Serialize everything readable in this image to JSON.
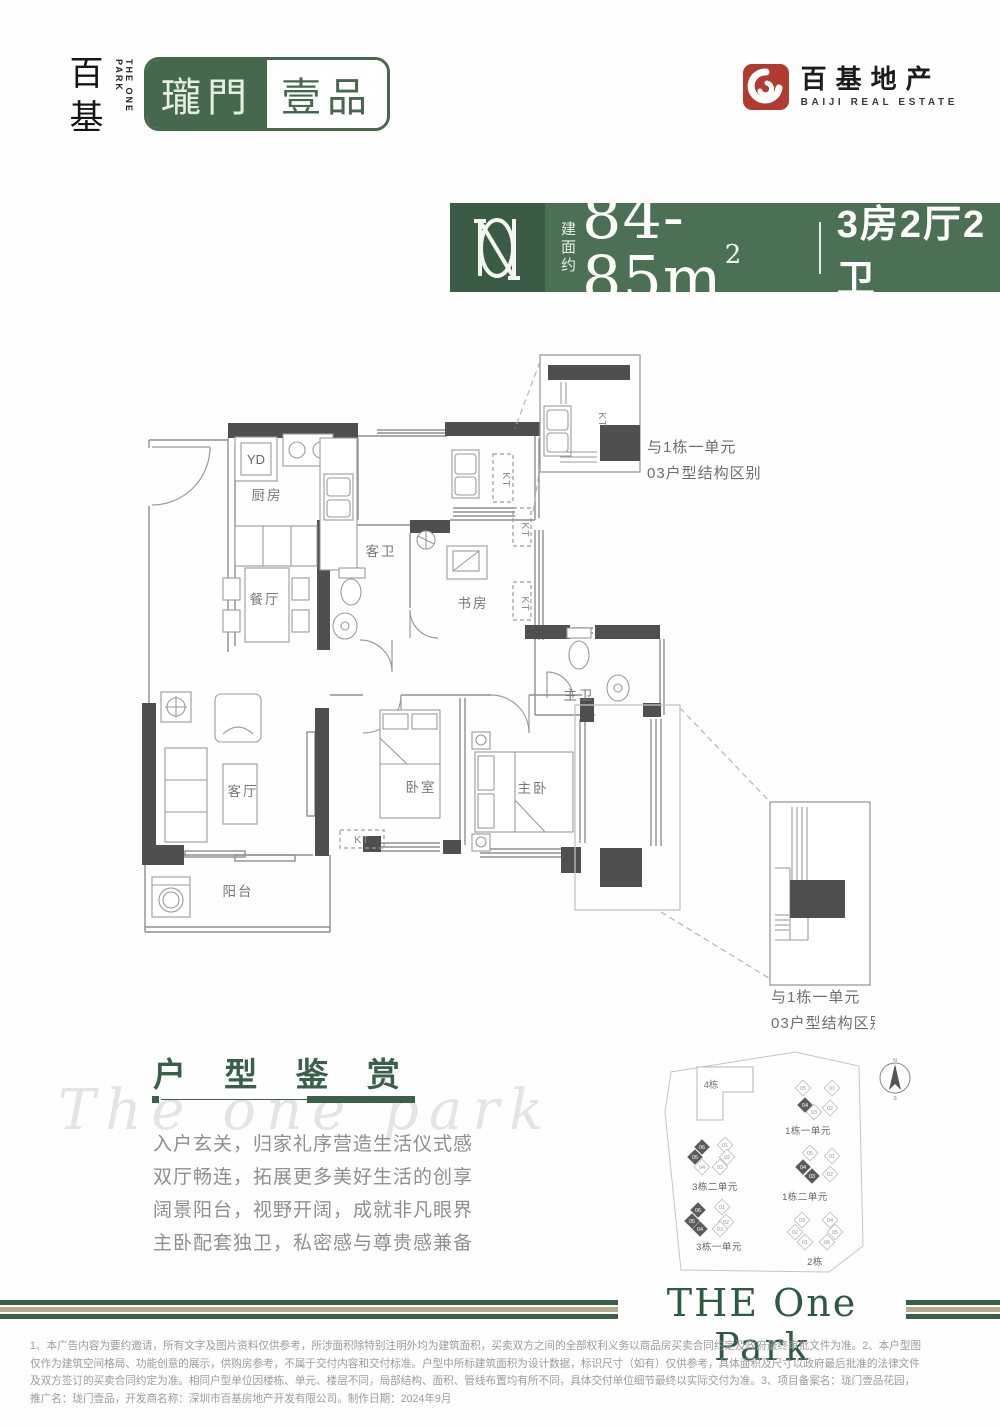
{
  "brand": {
    "left": {
      "chars": "百基",
      "sub": "THE ONE PARK",
      "seal_a": "瓏門",
      "seal_b": "壹品"
    },
    "right": {
      "name": "百基地产",
      "sub": "BAIJI REAL ESTATE"
    }
  },
  "headline": {
    "area_label": "建面约",
    "area": "84-85m",
    "sup": "2",
    "rooms": "3房2厅2卫"
  },
  "floorplan": {
    "yd": "YD",
    "kt": "KT",
    "rooms": [
      {
        "name": "厨房",
        "x": 172,
        "y": 160
      },
      {
        "name": "餐厅",
        "x": 170,
        "y": 264
      },
      {
        "name": "客卫",
        "x": 286,
        "y": 216
      },
      {
        "name": "书房",
        "x": 378,
        "y": 268
      },
      {
        "name": "主卫",
        "x": 484,
        "y": 360
      },
      {
        "name": "客厅",
        "x": 148,
        "y": 456
      },
      {
        "name": "阳台",
        "x": 143,
        "y": 556
      },
      {
        "name": "卧室",
        "x": 326,
        "y": 452
      },
      {
        "name": "主卧",
        "x": 438,
        "y": 453
      }
    ],
    "kt_marks": [
      {
        "x": 427,
        "y": 190,
        "rot": 90
      },
      {
        "x": 427,
        "y": 264,
        "rot": 90
      },
      {
        "x": 267,
        "y": 503,
        "rot": 0
      },
      {
        "x": 408,
        "y": 140,
        "rot": 90
      },
      {
        "x": 504,
        "y": 80,
        "rot": 90
      }
    ],
    "callouts": [
      {
        "lines": [
          "与1栋一单元",
          "03户型结构区别"
        ],
        "x": 552,
        "y": 112,
        "dy": 26
      },
      {
        "lines": [
          "与1栋一单元",
          "03户型结构区别"
        ],
        "x": 676,
        "y": 662,
        "dy": 26
      }
    ]
  },
  "appreciation": {
    "watermark": "The one park",
    "title": "户 型 鉴 赏",
    "lines": [
      "入户玄关，归家礼序营造生活仪式感",
      "双厅畅连，拓展更多美好生活的创享",
      "阔景阳台，视野开阔，成就非凡眼界",
      "主卧配套独卫，私密感与尊贵感兼备"
    ]
  },
  "siteplan": {
    "buildings": [
      {
        "label": "4栋",
        "x": 66,
        "y": 48
      }
    ],
    "clusters": [
      {
        "label": "1栋一单元",
        "lx": 163,
        "ly": 94,
        "units": [
          {
            "n": "05",
            "x": 158,
            "y": 48
          },
          {
            "n": "01",
            "x": 187,
            "y": 48
          },
          {
            "n": "04",
            "x": 160,
            "y": 65,
            "dark": true
          },
          {
            "n": "03",
            "x": 169,
            "y": 72
          },
          {
            "n": "02",
            "x": 185,
            "y": 68
          }
        ]
      },
      {
        "label": "3栋二单元",
        "lx": 70,
        "ly": 150,
        "units": [
          {
            "n": "06",
            "x": 57,
            "y": 107,
            "dark": true
          },
          {
            "n": "01",
            "x": 80,
            "y": 105
          },
          {
            "n": "05",
            "x": 50,
            "y": 117,
            "dark": true
          },
          {
            "n": "02",
            "x": 82,
            "y": 117
          },
          {
            "n": "04",
            "x": 57,
            "y": 127
          },
          {
            "n": "03",
            "x": 75,
            "y": 127
          }
        ]
      },
      {
        "label": "1栋二单元",
        "lx": 160,
        "ly": 160,
        "units": [
          {
            "n": "05",
            "x": 165,
            "y": 113
          },
          {
            "n": "01",
            "x": 187,
            "y": 116
          },
          {
            "n": "04",
            "x": 158,
            "y": 127,
            "dark": true
          },
          {
            "n": "03",
            "x": 167,
            "y": 136,
            "dark": true
          },
          {
            "n": "02",
            "x": 185,
            "y": 134
          }
        ]
      },
      {
        "label": "3栋一单元",
        "lx": 74,
        "ly": 210,
        "units": [
          {
            "n": "06",
            "x": 53,
            "y": 170,
            "dark": true
          },
          {
            "n": "01",
            "x": 77,
            "y": 167
          },
          {
            "n": "05",
            "x": 47,
            "y": 181,
            "dark": true
          },
          {
            "n": "02",
            "x": 81,
            "y": 182
          },
          {
            "n": "04",
            "x": 55,
            "y": 189,
            "dark": true
          },
          {
            "n": "03",
            "x": 75,
            "y": 189
          }
        ]
      },
      {
        "label": "2栋",
        "lx": 170,
        "ly": 225,
        "units": [
          {
            "n": "03",
            "x": 157,
            "y": 180
          },
          {
            "n": "04",
            "x": 185,
            "y": 180
          },
          {
            "n": "02",
            "x": 150,
            "y": 192
          },
          {
            "n": "05",
            "x": 190,
            "y": 192
          },
          {
            "n": "01",
            "x": 160,
            "y": 202
          },
          {
            "n": "06",
            "x": 182,
            "y": 202
          }
        ]
      }
    ],
    "compass": {
      "n": "N",
      "s": "S"
    }
  },
  "footer": {
    "banner": "THE One Park"
  },
  "disclaimer": [
    "1、本广告内容为要约邀请，所有文字及图片资料仅供参考，所涉面积除特别注明外均为建筑面积，买卖双方之间的全部权利义务以商品房买卖合同约定及政府最终审批文件为准。2、本户型图",
    "仅作为建筑空间格局、功能创意的展示，供购房参考，不属于交付内容和交付标准。户型中所标建筑面积为设计数据，标识尺寸（如有）仅供参考，具体面积及尺寸以政府最后批准的法律文件",
    "及双方签订的买卖合同约定为准。相同户型单位因楼栋、单元、楼层不同，局部结构、面积、管线布置均有所不同，具体交付单位细节最终以实际交付为准。3、项目备案名：珑门壹品花园，",
    "推广名：珑门壹品，开发商名称：深圳市百基房地产开发有限公司。制作日期：2024年9月"
  ]
}
